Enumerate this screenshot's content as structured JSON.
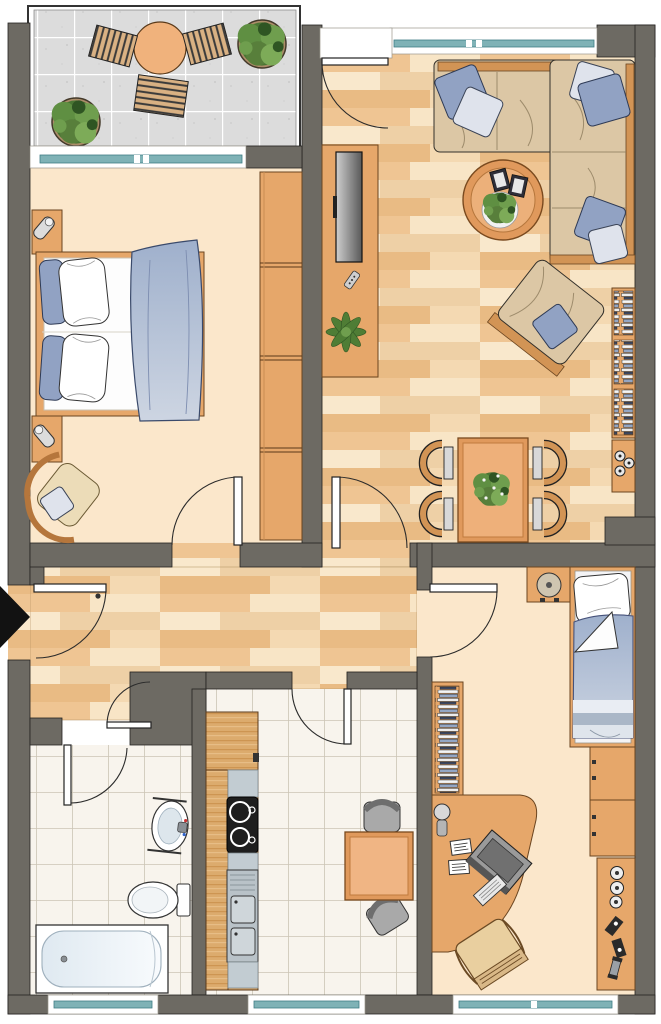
{
  "plan": {
    "type": "apartment-floor-plan",
    "palette": {
      "wall": "#6d6a63",
      "outline": "#232220",
      "parquet": "#f4dab4",
      "cream": "#fbe7cb",
      "tile": "#f8f4ed",
      "grout": "#ccc5b5",
      "balcony": "#dcdcdc",
      "wood": "#e6a76a",
      "woodline": "#6b4520",
      "kwood": "#dcab6d",
      "beige": "#dcc7a5",
      "blue": "#91a2c3",
      "lightblue": "#dfe3ec",
      "teal": "#7fb2b6",
      "tealline": "#3f7d85",
      "orange": "#eeb07a",
      "metal": "#b9c2c8",
      "dark": "#1e1e1e"
    },
    "rooms": [
      {
        "id": "balcony",
        "floor": "gray-tiles",
        "items": [
          "bistro-table",
          "slat-chair",
          "slat-chair",
          "slat-bench",
          "potted-plant",
          "potted-plant",
          "railing"
        ]
      },
      {
        "id": "living-room",
        "floor": "parquet",
        "items": [
          "corner-sofa",
          "cushion",
          "cushion",
          "cushion",
          "cushion",
          "cushion",
          "cushion",
          "coffee-table",
          "books",
          "houseplant",
          "tv-sideboard",
          "tv",
          "remote-control",
          "sideboard-plant",
          "armchair",
          "bookshelf",
          "hifi-cabinet",
          "dining-table",
          "dining-chair",
          "dining-chair",
          "dining-chair",
          "dining-chair",
          "window",
          "balcony-door"
        ]
      },
      {
        "id": "bedroom",
        "floor": "cream",
        "items": [
          "double-bed",
          "pillow",
          "pillow",
          "pillow",
          "pillow",
          "duvet",
          "nightstand",
          "nightstand",
          "table-lamp",
          "table-lamp",
          "wardrobe",
          "easy-chair",
          "cushion",
          "window",
          "door"
        ]
      },
      {
        "id": "hallway",
        "floor": "parquet",
        "items": [
          "entrance-door",
          "entrance-arrow",
          "wall-rail"
        ]
      },
      {
        "id": "bathroom",
        "floor": "white-tiles",
        "items": [
          "bathtub",
          "washbasin",
          "faucet",
          "toilet",
          "window",
          "door"
        ]
      },
      {
        "id": "kitchen",
        "floor": "white-tiles",
        "items": [
          "counter-run",
          "cooktop",
          "double-sink",
          "kitchen-table",
          "chair",
          "chair",
          "window",
          "door"
        ]
      },
      {
        "id": "kids-room",
        "floor": "cream",
        "items": [
          "single-bed",
          "pillow",
          "duvet",
          "nightstand",
          "ball-lamp",
          "bookshelf",
          "dresser",
          "dresser",
          "toy-shelf",
          "toy",
          "toy",
          "toy",
          "corner-desk",
          "monitor",
          "keyboard",
          "papers",
          "desk-lamp",
          "desk-chair",
          "window",
          "door"
        ]
      }
    ]
  }
}
